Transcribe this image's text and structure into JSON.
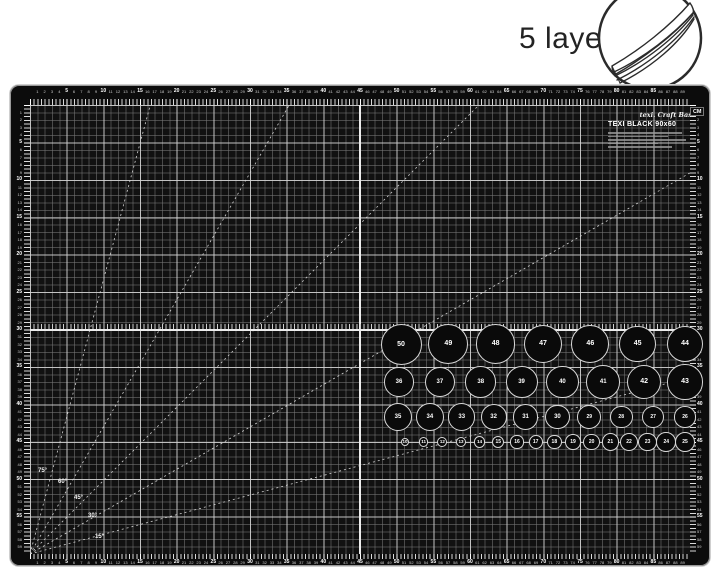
{
  "badge": {
    "label": "5 layers",
    "icon": "stacked-sheets-in-circle"
  },
  "mat": {
    "brand_script": "texi. Craft Base",
    "brand_model": "TEXI BLACK 90x60",
    "unit_label": "CM",
    "rulers": {
      "top": {
        "from": 1,
        "to": 89,
        "bold_every": 5
      },
      "bottom": {
        "from": 1,
        "to": 89,
        "bold_every": 5
      },
      "left": {
        "from": 1,
        "to": 59,
        "bold_every": 5
      },
      "right": {
        "from": 1,
        "to": 59,
        "bold_every": 5
      }
    },
    "angle_lines_deg": [
      15,
      30,
      45,
      60,
      75
    ],
    "angle_labels": [
      {
        "label": "75°",
        "x": 8,
        "y": 363
      },
      {
        "label": "60°",
        "x": 28,
        "y": 374
      },
      {
        "label": "45°",
        "x": 44,
        "y": 390
      },
      {
        "label": "30°",
        "x": 58,
        "y": 408
      },
      {
        "label": "15°",
        "x": 65,
        "y": 429
      }
    ],
    "circle_rows": [
      {
        "y": 239,
        "x_start": 371,
        "x_end": 655,
        "values": [
          50,
          49,
          48,
          47,
          46,
          45,
          44
        ]
      },
      {
        "y": 277,
        "x_start": 369,
        "x_end": 655,
        "values": [
          36,
          37,
          38,
          39,
          40,
          41,
          42,
          43
        ]
      },
      {
        "y": 312,
        "x_start": 368,
        "x_end": 655,
        "values": [
          35,
          34,
          33,
          32,
          31,
          30,
          29,
          28,
          27,
          26
        ]
      },
      {
        "y": 337,
        "x_start": 375,
        "x_end": 655,
        "values": [
          10,
          11,
          12,
          13,
          14,
          15,
          16,
          17,
          18,
          19,
          20,
          21,
          22,
          23,
          24,
          25
        ]
      }
    ]
  },
  "colors": {
    "mat_black": "#0c0c0c",
    "grid_minor_line": "#787878",
    "grid_major_line": "#d7d7d7",
    "center_line": "#ececec",
    "circle_outline": "#d8d8d8",
    "badge_text": "#232323",
    "background": "#ffffff"
  }
}
